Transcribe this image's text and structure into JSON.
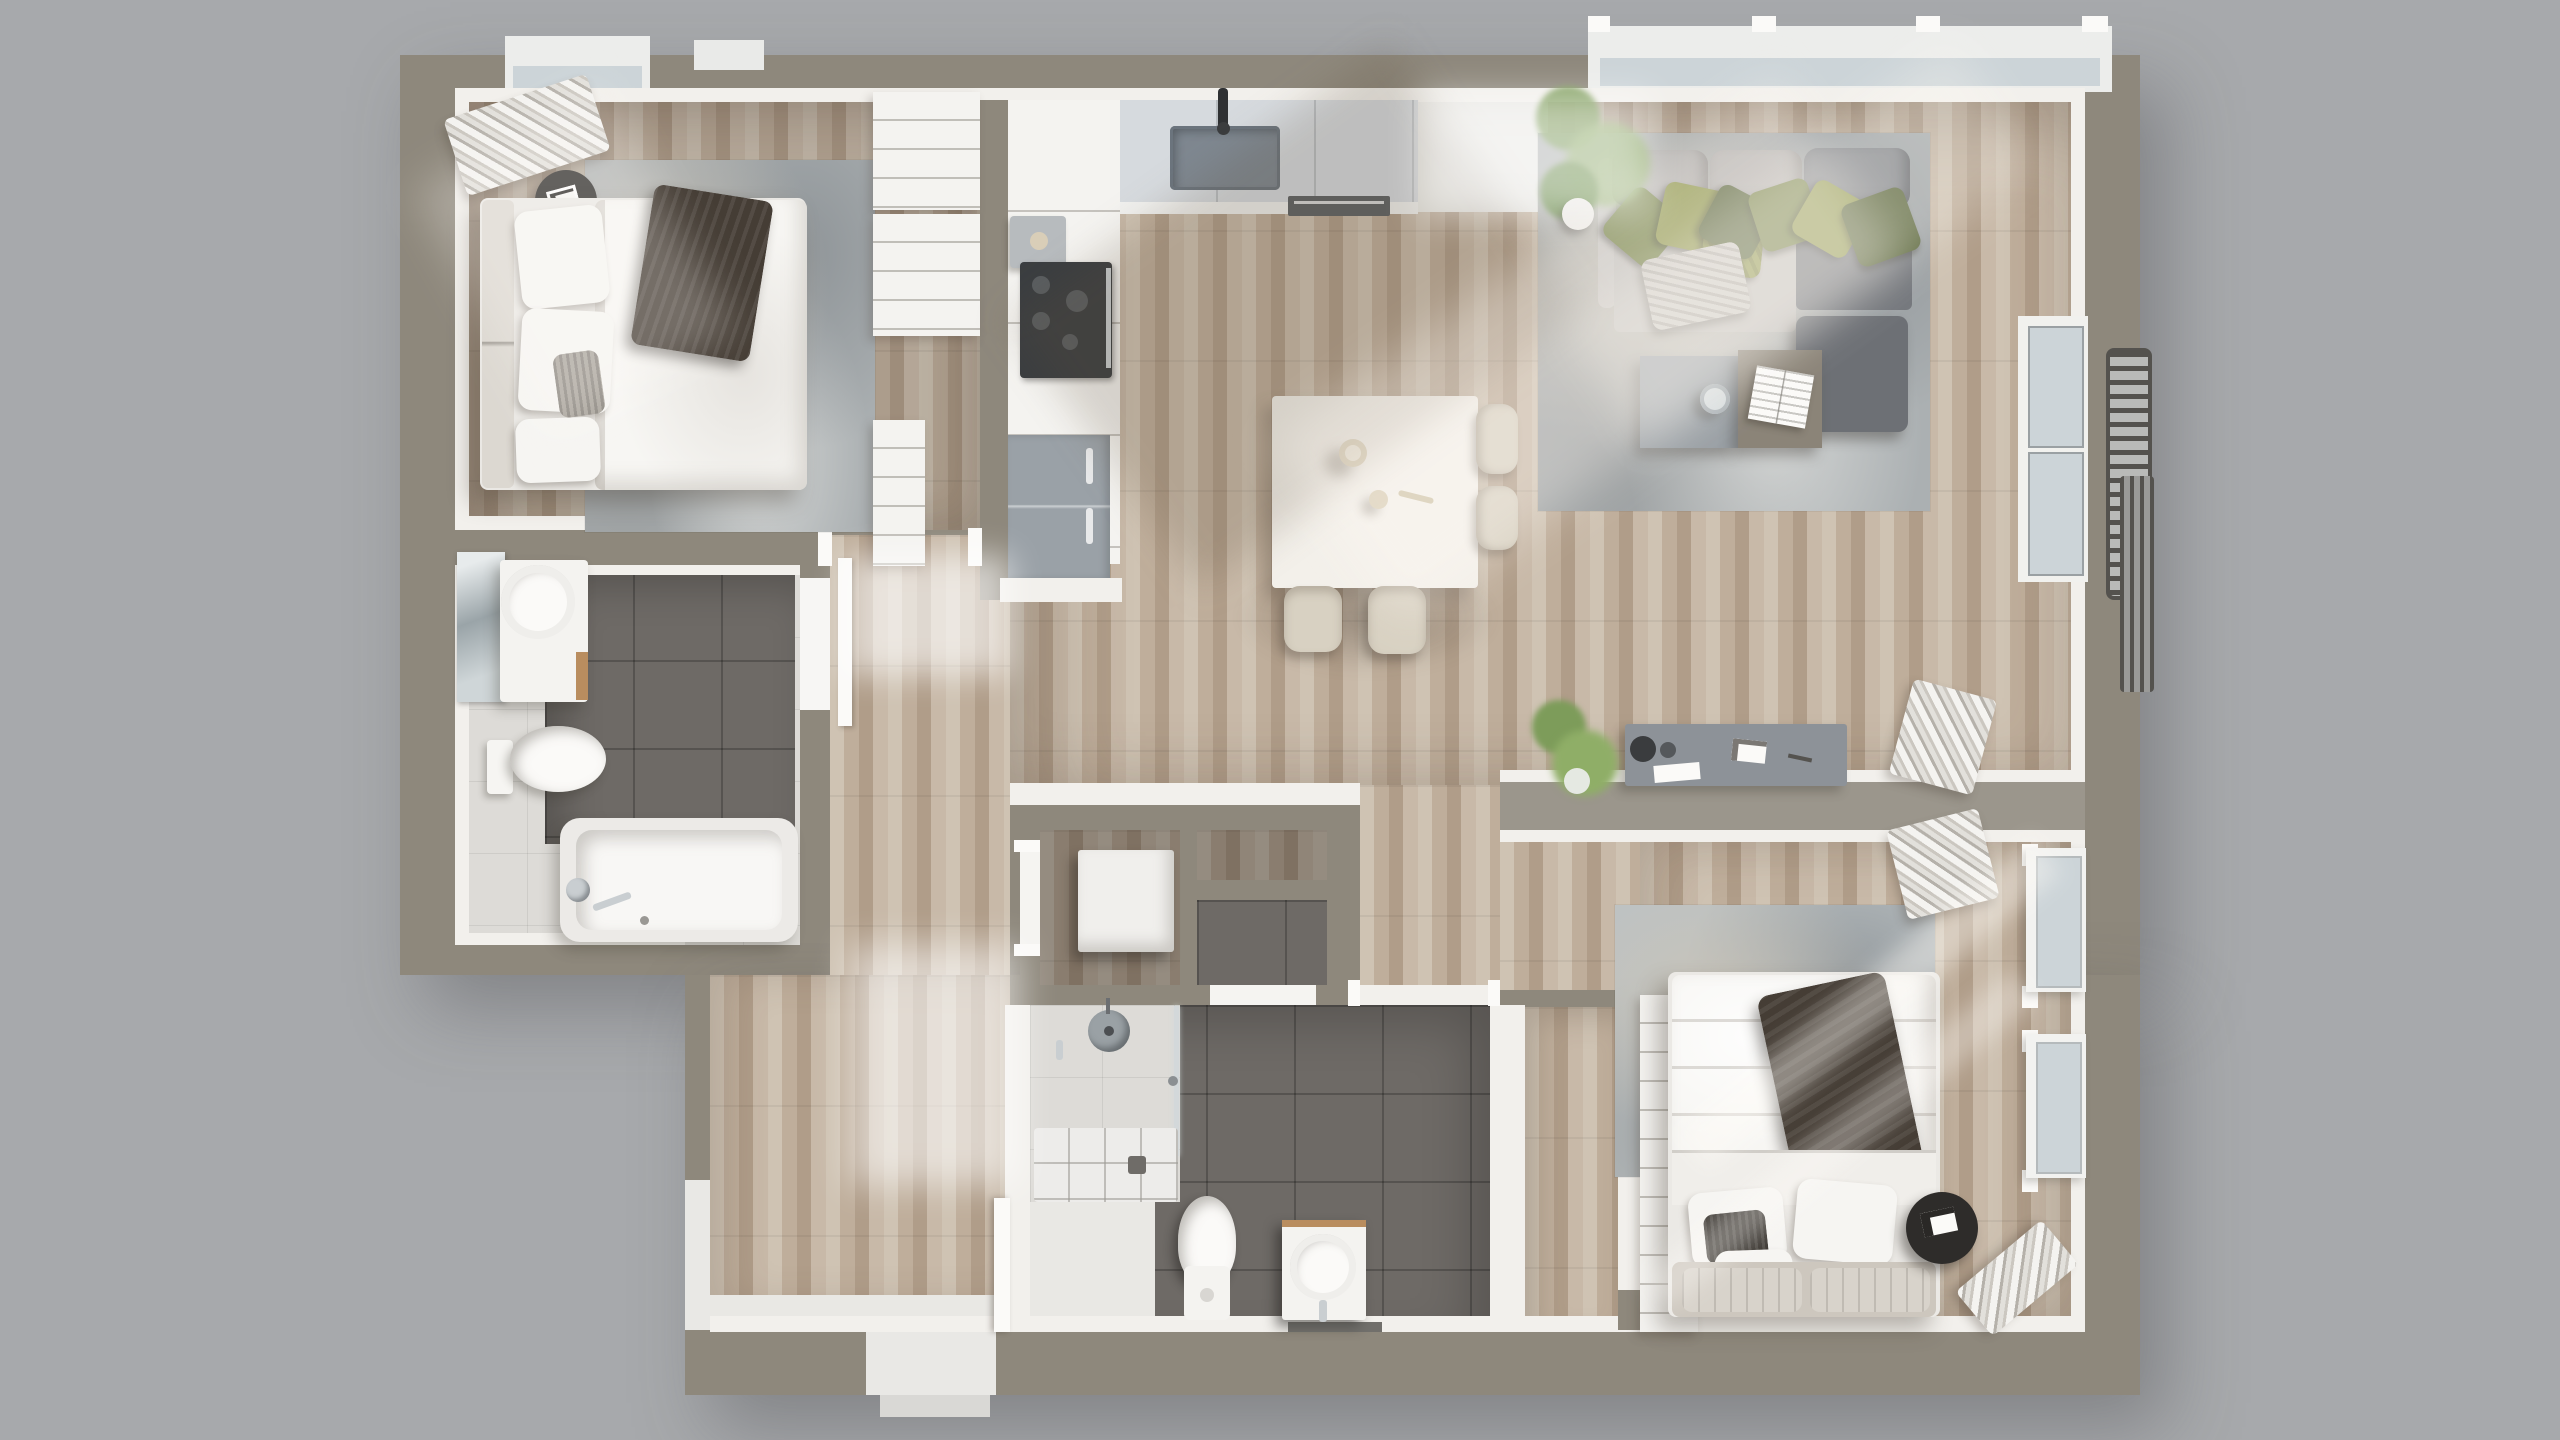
{
  "scene": {
    "type": "3d-floor-plan-top-down-render",
    "description": "Photorealistic top-view 3D floor plan of a two-bedroom apartment, no text labels visible"
  },
  "palette": {
    "bg": "#a7a9ac",
    "wall": "#8e887c",
    "walldesk": "#9b968c",
    "inface": "#f2f0ec",
    "floorlight": "#e9e8e4",
    "wooda": "#cfc3b3",
    "woodb": "#bfae9b",
    "woodc": "#b09d89",
    "woodd": "#c8b9a8",
    "tiledark": "#6e6a66",
    "tilelight": "#dddbd7",
    "whitefurn": "#f4f3f0",
    "sofalight": "#c0bebb",
    "sofaback": "#b4b2b0",
    "sofadark": "#74777c",
    "chair": "#d8d1c2",
    "green1": "#8f974e",
    "green2": "#768349",
    "green3": "#5a663c",
    "throwdark": "#453d35",
    "counter": "#d6dade",
    "sink": "#7e8790",
    "cooktop": "#3a3d40",
    "fridge": "#9aa1a7",
    "desk": "#8d9298",
    "tableblack": "#2e2c2a",
    "plant": "#7d9c5a",
    "chrome": "#c9ced1",
    "woodaccent": "#b98d5f",
    "railing": "#54524e",
    "ruga": "#abb0b2",
    "rugb": "#bcc2c4",
    "glass": "#ccd4d8",
    "beddark": "#3f3b36"
  },
  "rooms": [
    "bedroom-1",
    "bathroom-1",
    "kitchen",
    "dining-area",
    "living-room",
    "hallway",
    "entry",
    "storage-closet",
    "utility-niches",
    "bathroom-2",
    "walk-in-closet",
    "bedroom-2",
    "balcony"
  ],
  "furniture": {
    "bedroom_1": [
      "double-bed",
      "white-duvet",
      "dark-throw-blanket",
      "pillows",
      "round-side-table",
      "open-clothes-rail",
      "area-rug",
      "closet-shelving",
      "window-bay"
    ],
    "bathroom_1": [
      "mirror",
      "vanity-with-round-basin",
      "toilet",
      "bathtub",
      "chrome-fixtures"
    ],
    "kitchen": [
      "l-shaped-counter",
      "sink-with-faucet",
      "cooktop",
      "oven",
      "refrigerator",
      "coffee-machine"
    ],
    "dining_area": [
      "square-white-table",
      "four-beige-chairs",
      "two-cups"
    ],
    "living_room": [
      "l-shaped-sectional-sofa",
      "green-velvet-pillows",
      "gray-throw",
      "two-tone-coffee-table",
      "open-magazine",
      "drinking-glass",
      "ottoman",
      "area-rug",
      "potted-plant",
      "window-bay",
      "balcony-door"
    ],
    "workspace": [
      "wall-desk",
      "desk-lamp",
      "papers",
      "potted-plant",
      "magazine-stack"
    ],
    "storage": [
      "washing-machine-box",
      "wood-niche",
      "tiled-niche"
    ],
    "bathroom_2": [
      "walk-in-shower",
      "shower-head",
      "glass-screen",
      "shower-tray",
      "toilet",
      "vanity-with-round-basin",
      "dark-floor-tiles"
    ],
    "bedroom_2": [
      "double-bed",
      "white-duvet",
      "dark-throw-blanket",
      "pillows",
      "tufted-headboard",
      "round-side-table",
      "area-rug",
      "built-in-wardrobe",
      "clothes-stacks",
      "two-windows"
    ],
    "balcony": [
      "juliet-railing",
      "radiator"
    ]
  }
}
